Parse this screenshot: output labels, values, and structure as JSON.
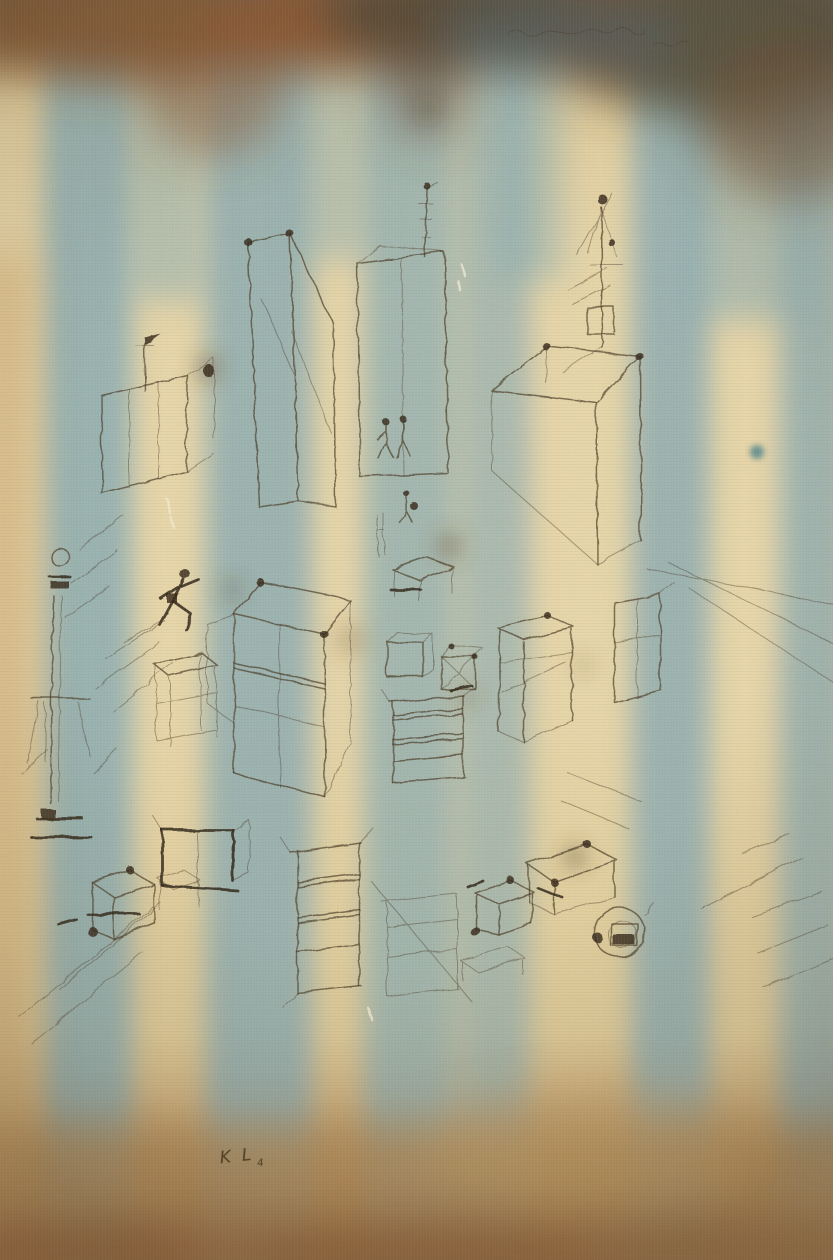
{
  "artwork": {
    "description": "Abstract watercolor: a pen-and-ink perspective drawing of open boxes, crates, towers, a street column and tiny running figures, laid over soft vertical blue watercolor stripes on cream paper, with umber and rust washes bleeding along the top edge and an ochre wash along the bottom.",
    "signature": {
      "initials": "KL",
      "mark": "4"
    },
    "top_inscription": "faint illegible handwritten line",
    "stripe_count": 6,
    "palette": {
      "paper_cream": "#e8d6a8",
      "paper_cream_deep": "#d9c190",
      "stripe_blue": "#86abb5",
      "top_umber": "#6b5138",
      "top_rust": "#94582f",
      "top_dark_sepia": "#4e4637",
      "top_teal_grey": "#56656a",
      "bottom_ochre": "#b08a55",
      "bottom_rust": "#8d5c35",
      "ink_brown": "#473823",
      "ink_dark": "#2f2517"
    },
    "elements": [
      "street-column-with-lamp",
      "small-flag-pole",
      "open-crate-left",
      "tall-slab-box",
      "center-tall-box-with-antenna",
      "large-box-right",
      "tower-top-right",
      "running-figure",
      "small-standing-figures",
      "stacked-open-crates",
      "cubes-with-cross-bracing",
      "dark-outlined-crate",
      "ladder-rung-crates",
      "circle-spiral-object",
      "perspective-recession-lines"
    ]
  }
}
